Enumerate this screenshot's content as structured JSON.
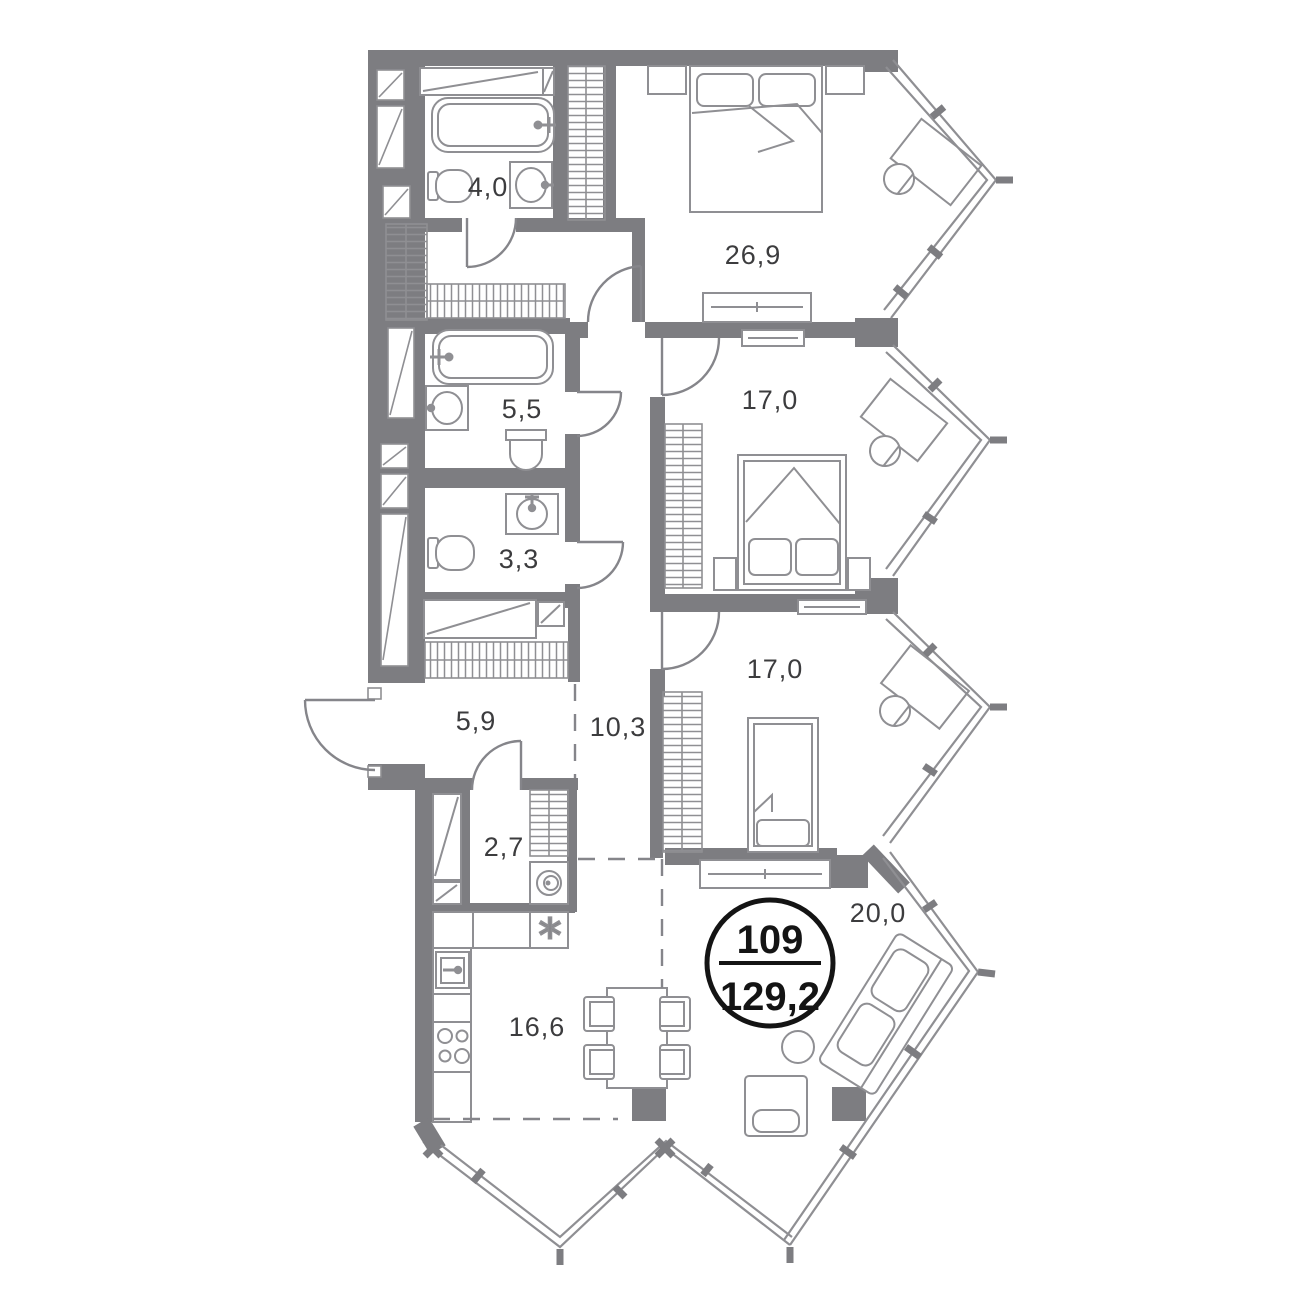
{
  "plan": {
    "unit_number": "109",
    "total_area": "129,2",
    "rooms": [
      {
        "id": "bathroom-1",
        "area": "4,0"
      },
      {
        "id": "bedroom-1",
        "area": "26,9"
      },
      {
        "id": "bathroom-2",
        "area": "5,5"
      },
      {
        "id": "wc",
        "area": "3,3"
      },
      {
        "id": "bedroom-2",
        "area": "17,0"
      },
      {
        "id": "bedroom-3",
        "area": "17,0"
      },
      {
        "id": "hallway",
        "area": "5,9"
      },
      {
        "id": "corridor",
        "area": "10,3"
      },
      {
        "id": "utility",
        "area": "2,7"
      },
      {
        "id": "kitchen",
        "area": "16,6"
      },
      {
        "id": "living-room",
        "area": "20,0"
      }
    ],
    "symbols": {
      "kitchen_star": "*"
    },
    "colors": {
      "wall": "#7d7d81",
      "line": "#8f8f93",
      "text": "#3c3c3e",
      "badge": "#141414"
    }
  }
}
